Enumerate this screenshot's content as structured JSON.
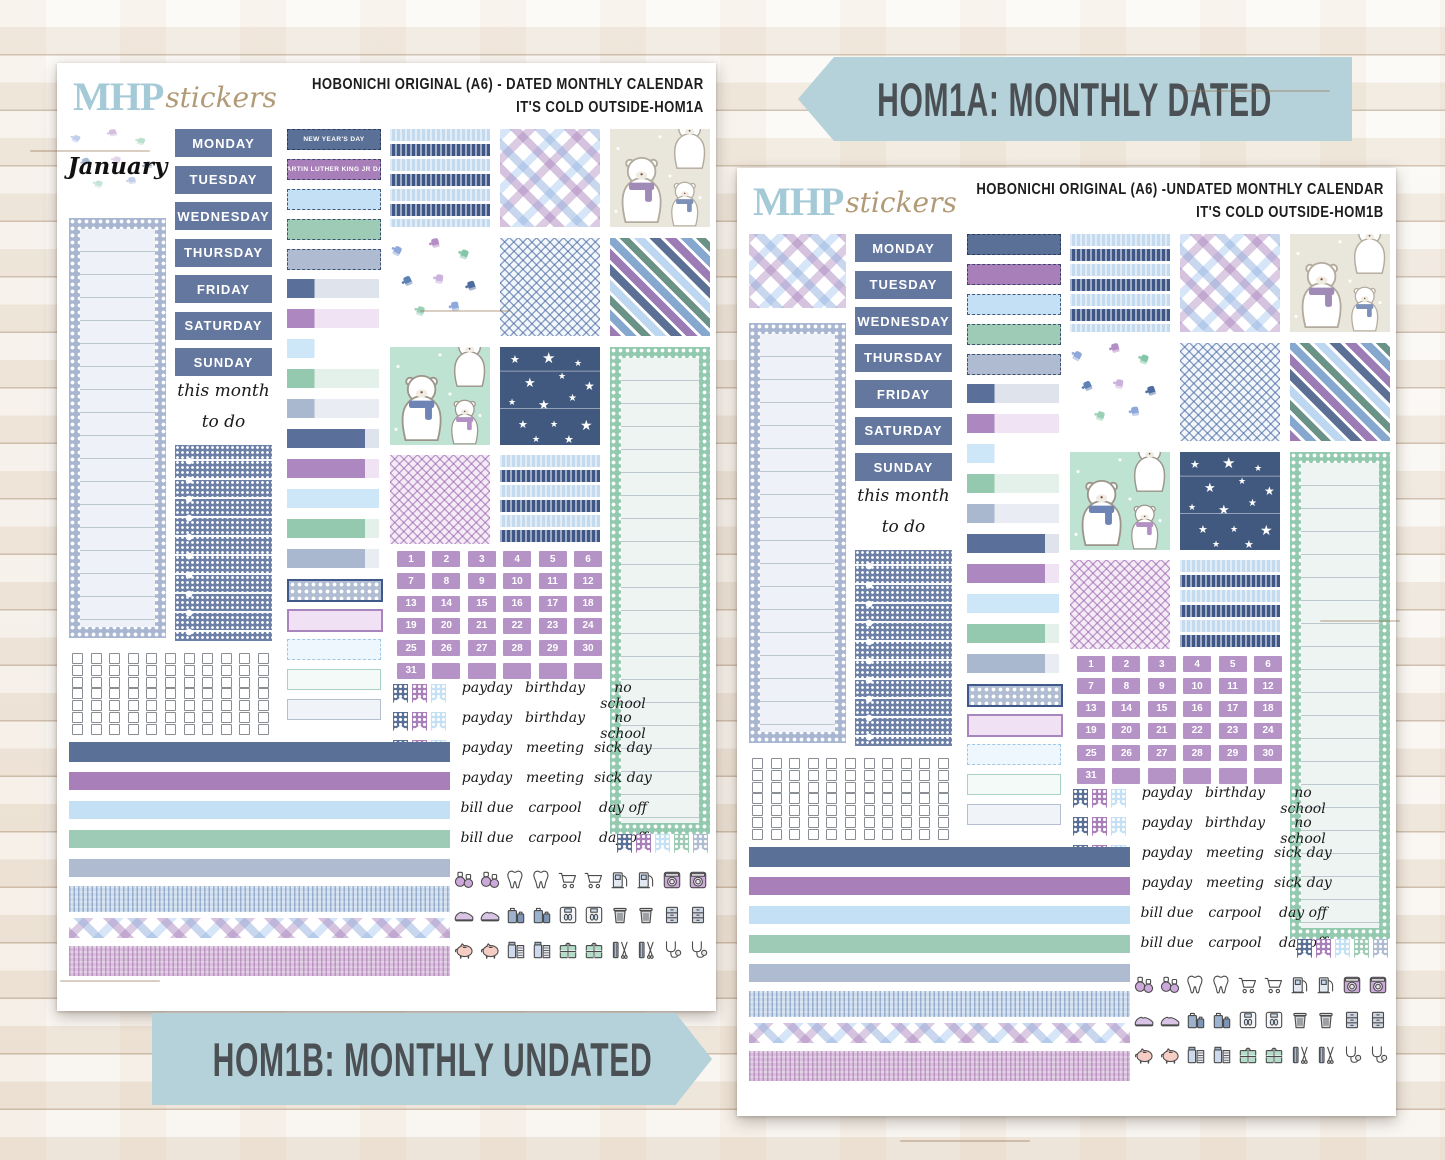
{
  "banners": {
    "top": "HOM1A: MONTHLY DATED",
    "bottom": "HOM1B: MONTHLY UNDATED"
  },
  "palette": {
    "navy": "#41588a",
    "slate_weekday": "#64779f",
    "purple": "#a985bd",
    "date_purple": "#b593c7",
    "lightblue": "#c9e3f7",
    "mint": "#9acbb2",
    "grayblue": "#aab8cf",
    "banner_blue": "#b5d1d9",
    "logo_blue": "#a4c9d7",
    "logo_tan": "#b29a77"
  },
  "shared": {
    "weekdays": [
      "MONDAY",
      "TUESDAY",
      "WEDNESDAY",
      "THURSDAY",
      "FRIDAY",
      "SATURDAY",
      "SUNDAY"
    ],
    "this_month": "this month",
    "to_do": "to do",
    "dates": [
      1,
      2,
      3,
      4,
      5,
      6,
      7,
      8,
      9,
      10,
      11,
      12,
      13,
      14,
      15,
      16,
      17,
      18,
      19,
      20,
      21,
      22,
      23,
      24,
      25,
      26,
      27,
      28,
      29,
      30,
      31
    ],
    "date_blank_count": 5,
    "word_rows": [
      [
        "payday",
        "birthday",
        "no school"
      ],
      [
        "payday",
        "birthday",
        "no school"
      ],
      [
        "payday",
        "meeting",
        "sick day"
      ],
      [
        "payday",
        "meeting",
        "sick day"
      ],
      [
        "bill due",
        "carpool",
        "day off"
      ],
      [
        "bill due",
        "carpool",
        "day off"
      ]
    ],
    "icon_rows": [
      [
        "dumbbell",
        "dumbbell",
        "tooth",
        "tooth",
        "shopping-cart",
        "shopping-cart",
        "gas-pump",
        "gas-pump",
        "washing-machine",
        "washing-machine"
      ],
      [
        "sneaker",
        "sneaker",
        "luggage",
        "luggage",
        "scale",
        "scale",
        "trash-can",
        "trash-can",
        "file-cabinet",
        "file-cabinet"
      ],
      [
        "piggy-bank",
        "piggy-bank",
        "medicine",
        "medicine",
        "gift",
        "gift",
        "haircut",
        "haircut",
        "stethoscope",
        "stethoscope"
      ]
    ],
    "washi_strips": [
      "navy",
      "purple",
      "lightblue",
      "mint",
      "grayblue",
      "knit-blue",
      "plaid",
      "knit-purple"
    ],
    "pattern_grid": [
      [
        "knit-rows",
        "plaid",
        "bears-white"
      ],
      [
        "mittens",
        "herringbone-blue",
        "diag-stripes"
      ],
      [
        "bears-mint",
        "stars-navy",
        "mint-list"
      ]
    ],
    "pattern_row2": [
      "herringbone-purple",
      "knit-rows"
    ],
    "flag_cluster_small": [
      "navy",
      "purple",
      "lightblue"
    ],
    "flag_cluster_small_rows": 3,
    "flag_cluster_large": [
      "navy",
      "purple",
      "lightblue",
      "mint",
      "grayblue"
    ],
    "checkbox_grid": {
      "rows": 7,
      "cols": 11
    }
  },
  "sheets": [
    {
      "logo_main": "MHP",
      "logo_sub": "stickers",
      "title_line1": "HOBONICHI ORIGINAL (A6) - DATED MONTHLY CALENDAR",
      "title_line2": "IT'S COLD OUTSIDE-HOM1A",
      "month_label": "January",
      "month_pattern": "mittens",
      "label_stack": [
        {
          "style": "dashed-navy",
          "label": "NEW YEAR'S DAY"
        },
        {
          "style": "dashed-purple",
          "label": "MARTIN LUTHER KING JR DAY"
        },
        {
          "style": "dashed-lightblue",
          "label": ""
        },
        {
          "style": "dashed-mint",
          "label": ""
        },
        {
          "style": "dashed-grayblue",
          "label": ""
        },
        {
          "style": "split30-navy",
          "label": ""
        },
        {
          "style": "split30-purple",
          "label": ""
        },
        {
          "style": "split30-lightblue",
          "label": ""
        },
        {
          "style": "split30-mint",
          "label": ""
        },
        {
          "style": "split30-grayblue",
          "label": ""
        },
        {
          "style": "split85-navy",
          "label": ""
        },
        {
          "style": "split85-purple",
          "label": ""
        },
        {
          "style": "full-lightblue",
          "label": ""
        },
        {
          "style": "split85-mint",
          "label": ""
        },
        {
          "style": "split85-grayblue",
          "label": ""
        },
        {
          "style": "dotfill-grayblue",
          "label": ""
        },
        {
          "style": "outline-pink",
          "label": ""
        },
        {
          "style": "dashedoutline-lightblue",
          "label": ""
        },
        {
          "style": "outlinelight-mint",
          "label": ""
        },
        {
          "style": "outlinelight-grayblue",
          "label": ""
        }
      ]
    },
    {
      "logo_main": "MHP",
      "logo_sub": "stickers",
      "title_line1": "HOBONICHI ORIGINAL (A6) -UNDATED MONTHLY CALENDAR",
      "title_line2": "IT'S COLD OUTSIDE-HOM1B",
      "month_label": "",
      "month_pattern": "plaid",
      "label_stack": [
        {
          "style": "dashed-navy",
          "label": ""
        },
        {
          "style": "dashed-purple",
          "label": ""
        },
        {
          "style": "dashed-lightblue",
          "label": ""
        },
        {
          "style": "dashed-mint",
          "label": ""
        },
        {
          "style": "dashed-grayblue",
          "label": ""
        },
        {
          "style": "split30-navy",
          "label": ""
        },
        {
          "style": "split30-purple",
          "label": ""
        },
        {
          "style": "split30-lightblue",
          "label": ""
        },
        {
          "style": "split30-mint",
          "label": ""
        },
        {
          "style": "split30-grayblue",
          "label": ""
        },
        {
          "style": "split85-navy",
          "label": ""
        },
        {
          "style": "split85-purple",
          "label": ""
        },
        {
          "style": "full-lightblue",
          "label": ""
        },
        {
          "style": "split85-mint",
          "label": ""
        },
        {
          "style": "split85-grayblue",
          "label": ""
        },
        {
          "style": "dotfill-grayblue",
          "label": ""
        },
        {
          "style": "outline-pink",
          "label": ""
        },
        {
          "style": "dashedoutline-lightblue",
          "label": ""
        },
        {
          "style": "outlinelight-mint",
          "label": ""
        },
        {
          "style": "outlinelight-grayblue",
          "label": ""
        }
      ]
    }
  ]
}
